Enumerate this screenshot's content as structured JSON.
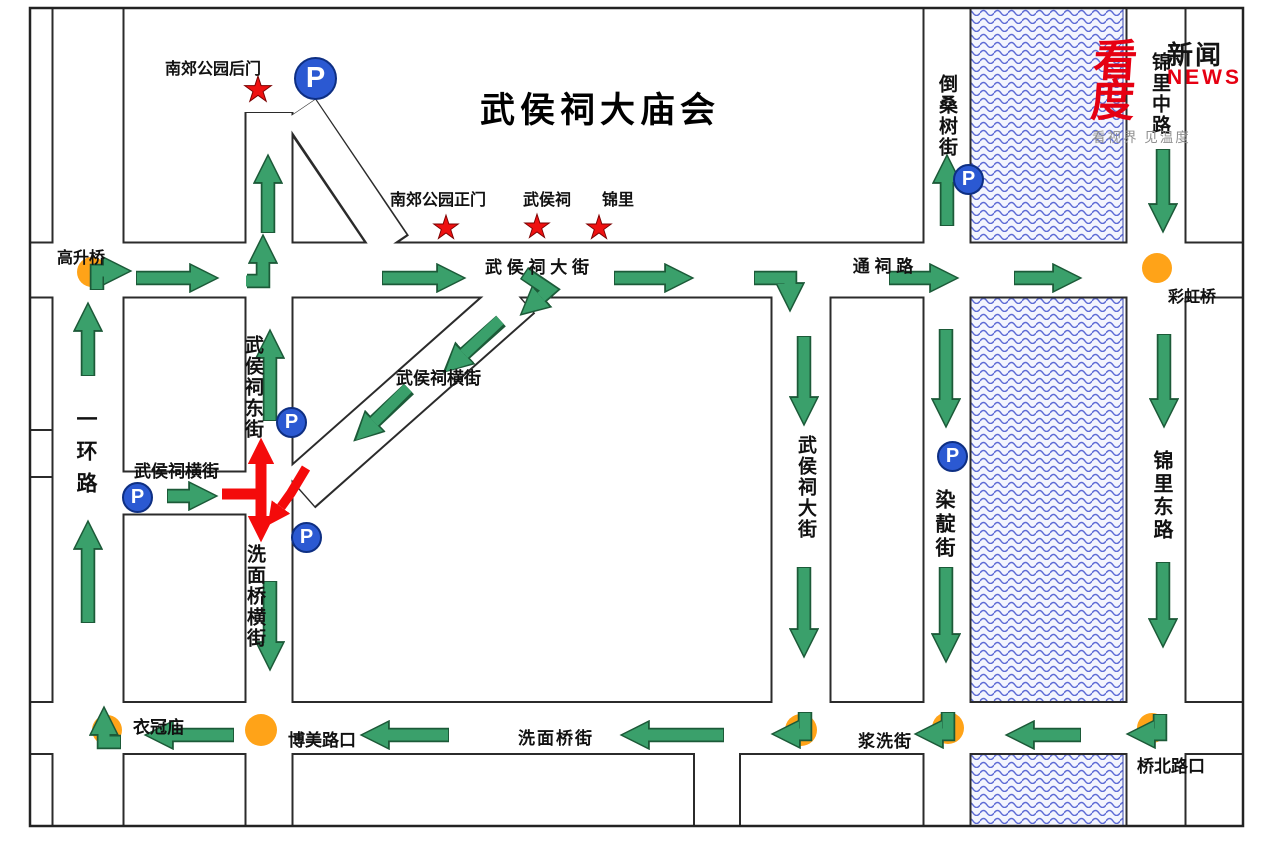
{
  "title": "武侯祠大庙会",
  "logo": {
    "brand": "看度",
    "brand2": "新闻",
    "news": "NEWS",
    "tagline": "看视界 见温度"
  },
  "icons": {
    "parking": "P"
  },
  "colors": {
    "arrow_green": "#3aa06b",
    "arrow_green_dark": "#1c5a38",
    "closure_red": "#f40b0b",
    "star_red": "#ee1111",
    "parking_blue": "#2b59d2",
    "junction_orange": "#ffa318",
    "river_blue": "#5d6bd5",
    "road_line": "#2b2b2b"
  },
  "labels": {
    "nanjiao_back_gate": "南郊公园后门",
    "nanjiao_main_gate": "南郊公园正门",
    "wuhouci": "武侯祠",
    "jinli": "锦里",
    "wuhouci_dajie": "武 侯 祠 大 街",
    "tongci_lu": "通 祠 路",
    "gaoshengqiao": "高升桥",
    "caihongqiao": "彩虹桥",
    "yihuan_lu": "一环路",
    "wuhouci_hengjie_west": "武侯祠横街",
    "wuhouci_hengjie_diag": "武侯祠横街",
    "wuhouci_dongjie": "武侯祠东街",
    "ximianqiao_hengjie": "洗面桥横街",
    "wuhouci_dajie_south": "武侯祠大街",
    "randian_jie": "染靛街",
    "daosangshu_jie": "倒桑树街",
    "jinli_zhonglu": "锦里中路",
    "jinli_donglu": "锦里东路",
    "yiguanmiao": "衣冠庙",
    "bomei_lukou": "博美路口",
    "ximianqiao_jie": "洗面桥街",
    "jiangxi_jie": "浆洗街",
    "qiaobei_lukou": "桥北路口"
  }
}
